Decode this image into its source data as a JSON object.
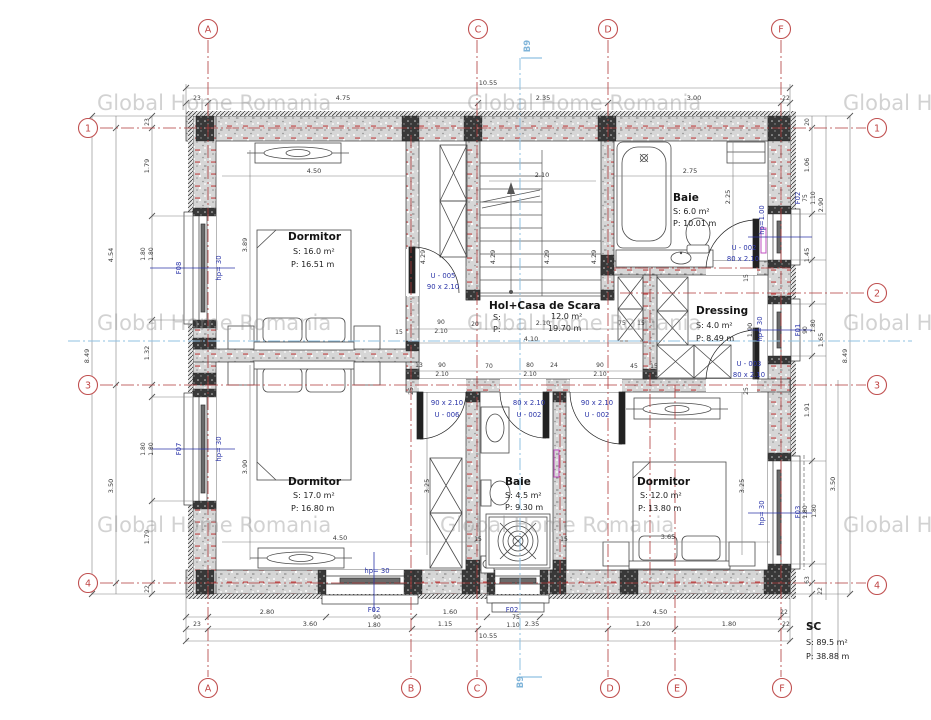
{
  "watermark": "Global Home Romania",
  "section": {
    "label": "B9"
  },
  "grid": {
    "a": "A",
    "b": "B",
    "c": "C",
    "d": "D",
    "e": "E",
    "f": "F",
    "r1": "1",
    "r2": "2",
    "r3": "3",
    "r4": "4"
  },
  "rooms": {
    "dormitor_tl": {
      "name": "Dormitor",
      "s": "S:  16.0 m²",
      "p": "P: 16.51 m"
    },
    "hol": {
      "name": "Hol+Casa de Scara",
      "s1": "S:",
      "s2": "12.0 m²",
      "p1": "P:",
      "p2": "19.70 m"
    },
    "baie_sus": {
      "name": "Baie",
      "s": "S:   6.0 m²",
      "p": "P: 10.01 m"
    },
    "dressing": {
      "name": "Dressing",
      "s": "S:   4.0 m²",
      "p": "P:  8.49 m"
    },
    "dormitor_bl": {
      "name": "Dormitor",
      "s": "S:  17.0 m²",
      "p": "P: 16.80 m"
    },
    "baie_jos": {
      "name": "Baie",
      "s": "S:  4.5 m²",
      "p": "P: 9.30 m"
    },
    "dormitor_br": {
      "name": "Dormitor",
      "s": "S:  12.0 m²",
      "p": "P: 13.80 m"
    },
    "sc": {
      "name": "SC",
      "s": "S:  89.5 m²",
      "p": "P: 38.88 m"
    }
  },
  "doors": {
    "u005": {
      "code": "U - 005",
      "size": "90 x 2.10"
    },
    "u002a": {
      "code": "U - 002",
      "size": "80 x 2.10"
    },
    "u003": {
      "code": "U - 003",
      "size": "80 x 2.10"
    },
    "u006": {
      "code": "U - 006",
      "size": "90 x 2.10"
    },
    "u002b": {
      "code": "U - 002",
      "size": "80 x 2.10"
    },
    "u002c": {
      "code": "U - 002",
      "size": "90 x 2.10"
    }
  },
  "windows": {
    "f08": {
      "code": "F08",
      "hp": "hp= 30"
    },
    "f07": {
      "code": "F07",
      "hp": "hp= 30"
    },
    "f02_dr": {
      "code": "F02",
      "w": "75",
      "hp": "hp=1.00",
      "h": "1.10"
    },
    "f01": {
      "code": "F01",
      "w": "90",
      "hp": "hp= 30",
      "h": "1.80"
    },
    "f03": {
      "code": "F03",
      "w": "1.80",
      "hp": "hp= 30",
      "h": "1.80"
    },
    "f02_bl": {
      "code": "F02",
      "w": "90",
      "hp": "hp= 30",
      "h": "1.80"
    },
    "f02_bc": {
      "code": "F02",
      "w": "75",
      "h": "1.10"
    }
  },
  "dims": {
    "d1055": "10.55",
    "d475": "4.75",
    "d235": "2.35",
    "d300": "3.00",
    "d23": "23",
    "d22": "22",
    "d280": "2.80",
    "d160": "1.60",
    "d450": "4.50",
    "d360": "3.60",
    "d115": "1.15",
    "d120": "1.20",
    "d180": "1.80",
    "d110": "1.10",
    "d849": "8.49",
    "d454": "4.54",
    "d350": "3.50",
    "d179": "1.79",
    "d132": "1.32",
    "d290": "2.90",
    "d165": "1.65",
    "d106": "1.06",
    "d145": "1.45",
    "d191": "1.91",
    "d63": "63",
    "d20": "20",
    "d90": "90",
    "d75": "75",
    "d80": "80",
    "d15": "15",
    "d13": "13",
    "d24": "24",
    "d45": "45",
    "d70": "70",
    "d25": "25",
    "d389": "3.89",
    "d390": "3.90",
    "d325": "3.25",
    "d365": "3.65",
    "d210": "2.10",
    "d429": "4.29",
    "d275": "2.75",
    "d225": "2.25",
    "d190": "1.90",
    "d410": "4.10"
  }
}
